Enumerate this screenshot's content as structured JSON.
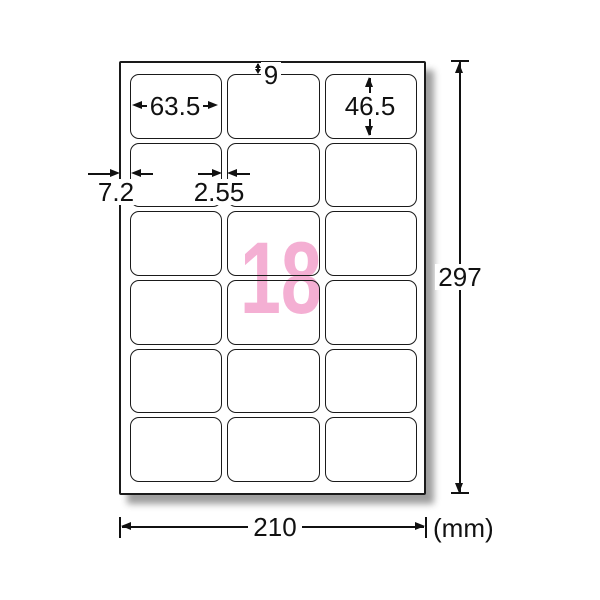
{
  "diagram": {
    "unit": "(mm)",
    "sheet_width": "210",
    "sheet_height": "297",
    "label_count": "18",
    "grid": {
      "rows": 6,
      "columns": 3
    },
    "label_width": "63.5",
    "label_height": "46.5",
    "top_margin": "9",
    "side_margin": "7.2",
    "column_gap": "2.55",
    "colors": {
      "count_pink": "#f4afd3",
      "line": "#111111"
    }
  }
}
